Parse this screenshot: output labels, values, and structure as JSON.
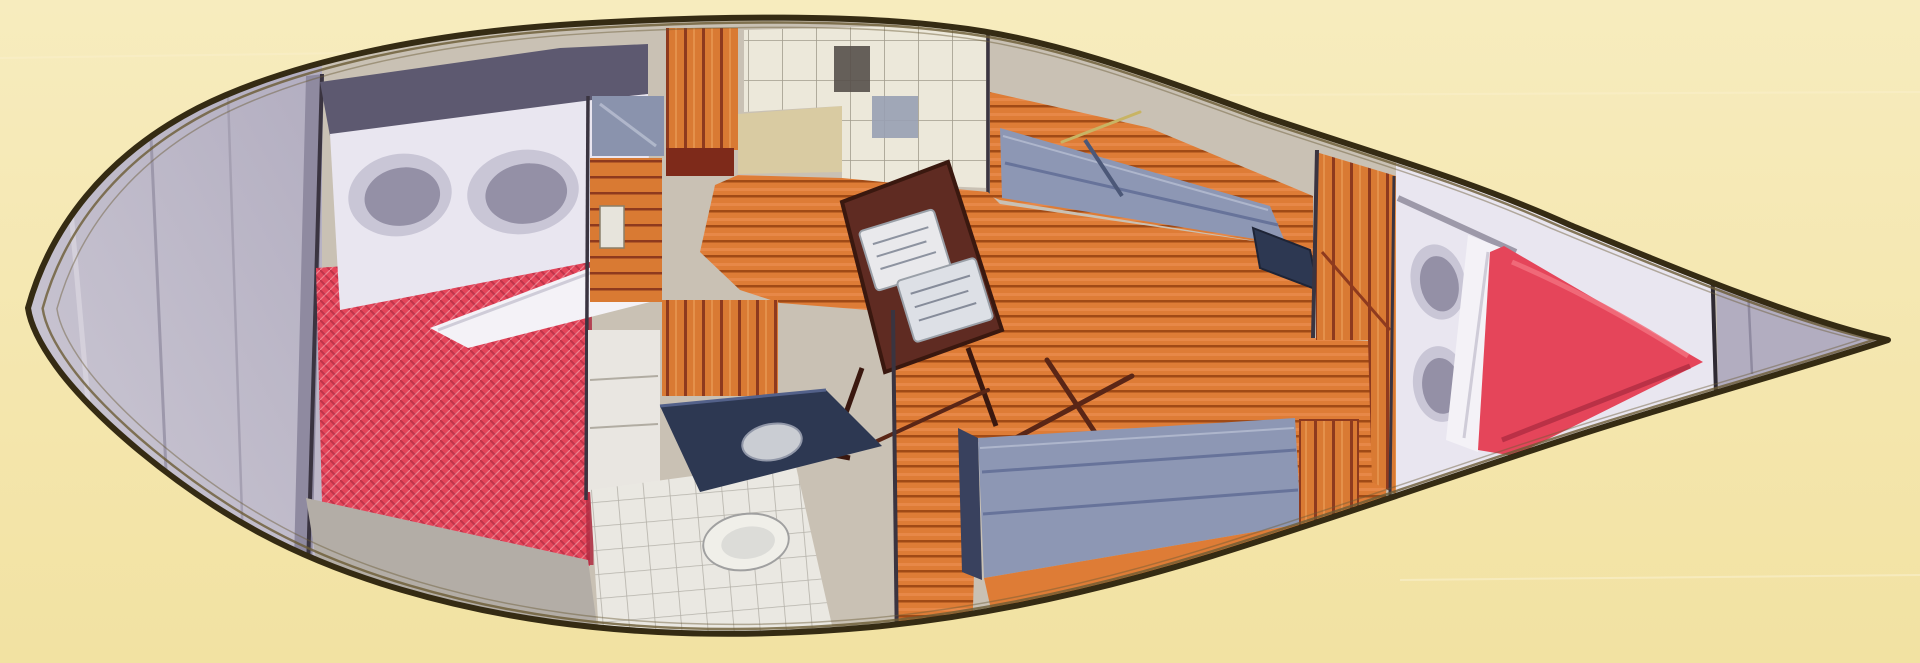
{
  "illustration": {
    "label": "sailboat-interior-floorplan-overhead-cutaway",
    "regions": [
      "stern-deck",
      "aft-cabin-double-berth",
      "galley",
      "salon",
      "dinette-table",
      "head-compartment",
      "port-settee",
      "starboard-settee",
      "nav-table",
      "v-berth",
      "bow-locker"
    ]
  },
  "canvas": {
    "viewBox": "0 0 1920 663"
  },
  "palette": {
    "background": "#f2e2a2",
    "background-light": "#f7ecbe",
    "hull-outline": "#352b13",
    "hull-lining": "#6b5b35",
    "interior-base": "#c9c1b4",
    "deck-gray": "#b2adc0",
    "deck-gray-light": "#cfcbd6",
    "deck-shade": "#8f8aa0",
    "slate": "#5d5970",
    "bedding-white": "#e9e6f0",
    "duvet-white": "#f4f2f7",
    "pillow-gray": "#9490a6",
    "pillow-rim": "#c9c6d6",
    "mattress-red": "#e5455a",
    "mattress-red-deep": "#b02c42",
    "mattress-highlight": "#f2707e",
    "wood-orange": "#d97a33",
    "wood-stripe": "#8e3a1e",
    "wood-light": "#eda45f",
    "sole-orange": "#de7c36",
    "sole-seam": "#a04a16",
    "sole-light": "#f0945a",
    "cushion-blue": "#8d97b4",
    "cushion-blue-dark": "#67739a",
    "cushion-highlight": "#aeb6cc",
    "locker-cream": "#ece8da",
    "locker-line": "#6f685a",
    "counter-tan": "#d9cba2",
    "counter-navy": "#2d3852",
    "navy-light": "#53618a",
    "table-maroon": "#5f2b22",
    "table-edge": "#3a180f",
    "tile-white": "#eae8e2",
    "tile-line": "#b5b2aa",
    "fixture-white": "#f0efe9",
    "stick-brown": "#5a2616",
    "accent-khaki": "#c8b464",
    "bulkhead-dark": "#3a3440"
  }
}
